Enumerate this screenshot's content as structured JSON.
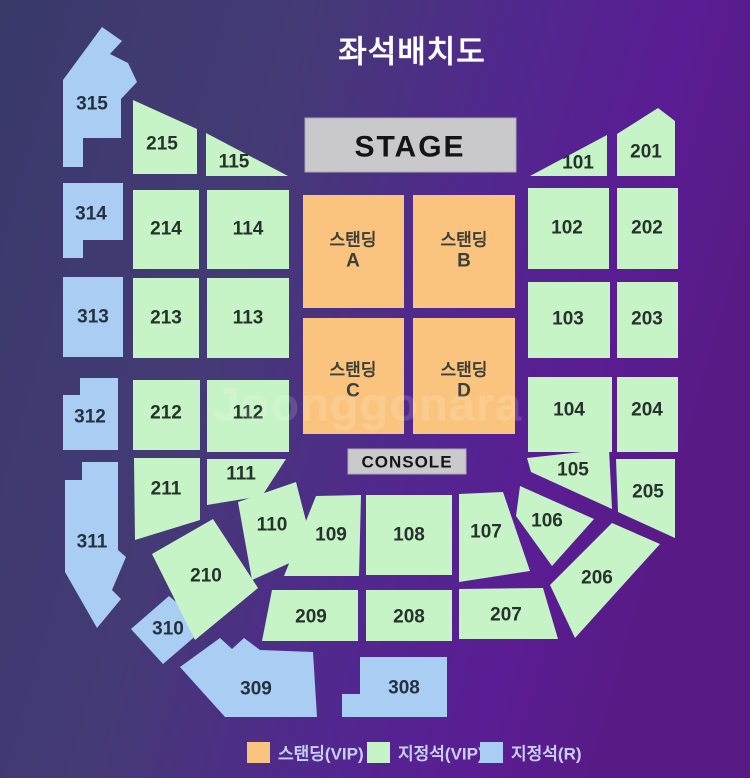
{
  "title": "좌석배치도",
  "watermark": "Joonggonara",
  "stage_label": "STAGE",
  "console_label": "CONSOLE",
  "colors": {
    "bg1": "#3a3a6b",
    "bg2": "#443a75",
    "bg3": "#52278f",
    "bg4": "#5a1d93",
    "bg5": "#581b86",
    "standing": "#FBC47E",
    "vip_seat": "#C7F4C7",
    "r_seat": "#A9CDF3",
    "stage_fill": "#C9C9CC",
    "console_fill": "#CACACC",
    "title_text": "#FFFFFF",
    "legend_text": "#C8D0F2"
  },
  "standing": {
    "a": {
      "name": "스탠딩",
      "letter": "A"
    },
    "b": {
      "name": "스탠딩",
      "letter": "B"
    },
    "c": {
      "name": "스탠딩",
      "letter": "C"
    },
    "d": {
      "name": "스탠딩",
      "letter": "D"
    }
  },
  "sections": {
    "s101": "101",
    "s102": "102",
    "s103": "103",
    "s104": "104",
    "s105": "105",
    "s106": "106",
    "s107": "107",
    "s108": "108",
    "s109": "109",
    "s110": "110",
    "s111": "111",
    "s112": "112",
    "s113": "113",
    "s114": "114",
    "s115": "115",
    "s201": "201",
    "s202": "202",
    "s203": "203",
    "s204": "204",
    "s205": "205",
    "s206": "206",
    "s207": "207",
    "s208": "208",
    "s209": "209",
    "s210": "210",
    "s211": "211",
    "s212": "212",
    "s213": "213",
    "s214": "214",
    "s215": "215",
    "s308": "308",
    "s309": "309",
    "s310": "310",
    "s311": "311",
    "s312": "312",
    "s313": "313",
    "s314": "314",
    "s315": "315"
  },
  "legend": {
    "standing_vip": "스탠딩(VIP)",
    "reserved_vip": "지정석(VIP)",
    "reserved_r": "지정석(R)"
  }
}
